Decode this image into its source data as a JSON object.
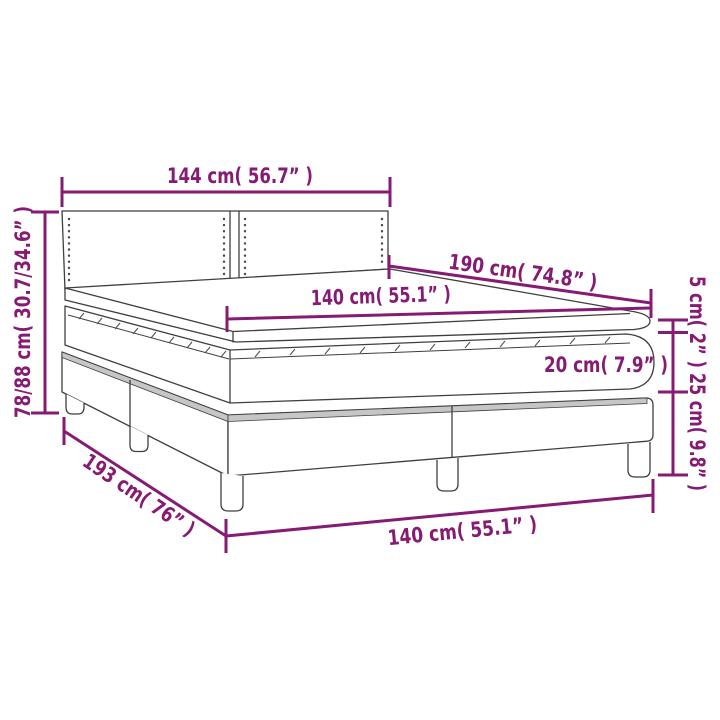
{
  "page": {
    "background": "#ffffff"
  },
  "diagram": {
    "subject": "box-spring-bed-with-headboard-dimension-diagram",
    "accent_color": "#851B72",
    "line_color": "#3f3f3f",
    "dimensions": {
      "headboard_width": "144 cm( 56.7” )",
      "bed_height": "78/88 cm( 30.7/34.6” )",
      "bed_length": "190 cm( 74.8” )",
      "mattress_width": "140 cm( 55.1” )",
      "topper_thickness": "5 cm( 2” )",
      "mattress_thickness": "20 cm( 7.9” )",
      "base_height": "25 cm( 9.8” )",
      "base_length": "193 cm( 76” )",
      "base_width": "140 cm( 55.1” )"
    }
  }
}
